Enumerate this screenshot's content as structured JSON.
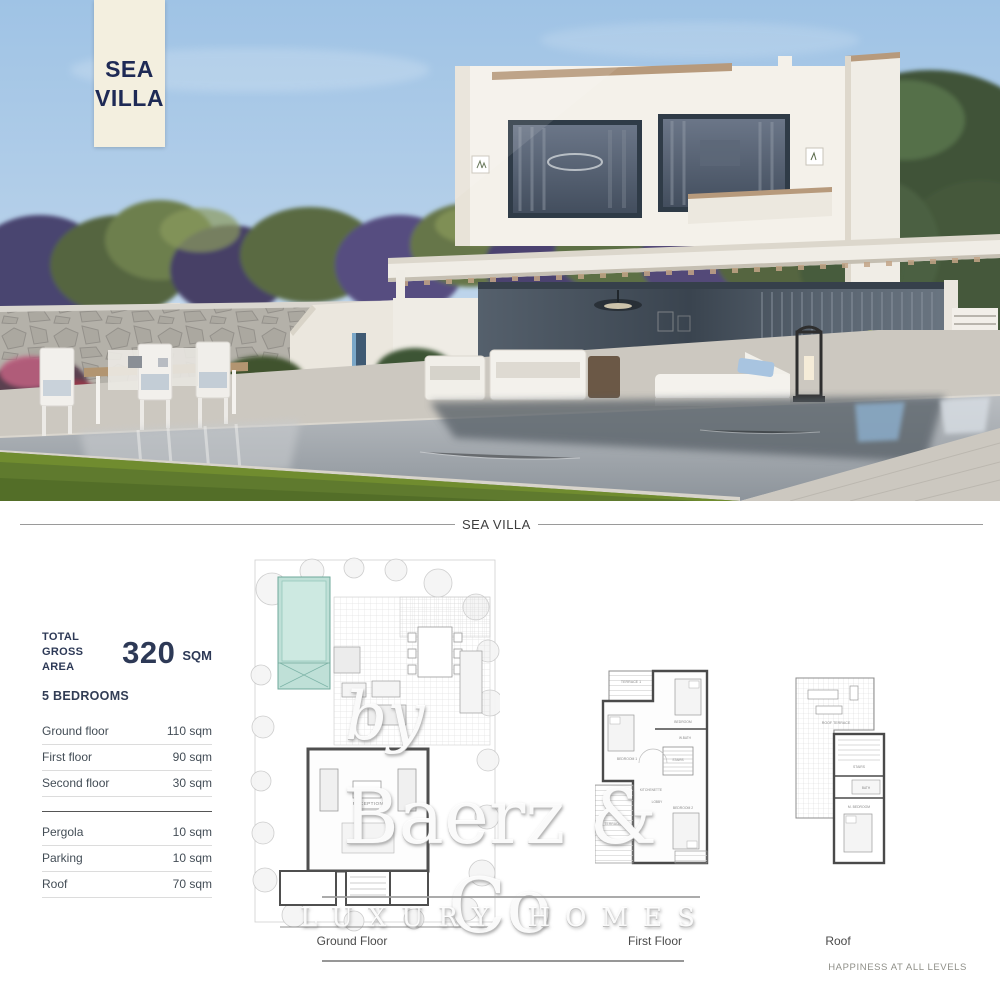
{
  "badge": {
    "line1": "SEA",
    "line2": "VILLA"
  },
  "section_divider": {
    "label": "SEA VILLA"
  },
  "stats": {
    "total_label_line1": "TOTAL",
    "total_label_line2": "GROSS AREA",
    "total_value": "320",
    "total_unit": "SQM",
    "bedrooms": "5 BEDROOMS",
    "floors": [
      {
        "label": "Ground floor",
        "value": "110 sqm"
      },
      {
        "label": "First floor",
        "value": "90 sqm"
      },
      {
        "label": "Second floor",
        "value": "30 sqm"
      }
    ],
    "extras": [
      {
        "label": "Pergola",
        "value": "10 sqm"
      },
      {
        "label": "Parking",
        "value": "10 sqm"
      },
      {
        "label": "Roof",
        "value": "70 sqm"
      }
    ]
  },
  "plans": {
    "ground": {
      "caption": "Ground Floor",
      "rooms": {
        "reception": "RECEPTION"
      }
    },
    "first": {
      "caption": "First Floor",
      "rooms": {
        "terrace1": "TERRACE 1",
        "bedroom1": "BEDROOM 1",
        "bedroom3": "BEDROOM",
        "bath": "W.BATH",
        "stairs": "STAIRS",
        "kitchenette": "KITCHENETTE",
        "lobby": "LOBBY",
        "bedroom2": "BEDROOM 2",
        "terrace2": "TERRACE 2"
      }
    },
    "roof": {
      "caption": "Roof",
      "rooms": {
        "roof_terrace": "ROOF TERRACE",
        "stairs": "STAIRS",
        "bath": "BATH",
        "m_bedroom": "M. BEDROOM"
      }
    }
  },
  "watermark": {
    "by": "by",
    "brand": "Baerz & Co",
    "tagline": "LUXURY HOMES"
  },
  "footer": {
    "slogan": "HAPPINESS AT ALL LEVELS"
  },
  "colors": {
    "accent_navy": "#2d3956",
    "badge_bg": "#f3efdf",
    "sky": "#a6c7e7",
    "plan_pool": "#bfe0d7"
  }
}
